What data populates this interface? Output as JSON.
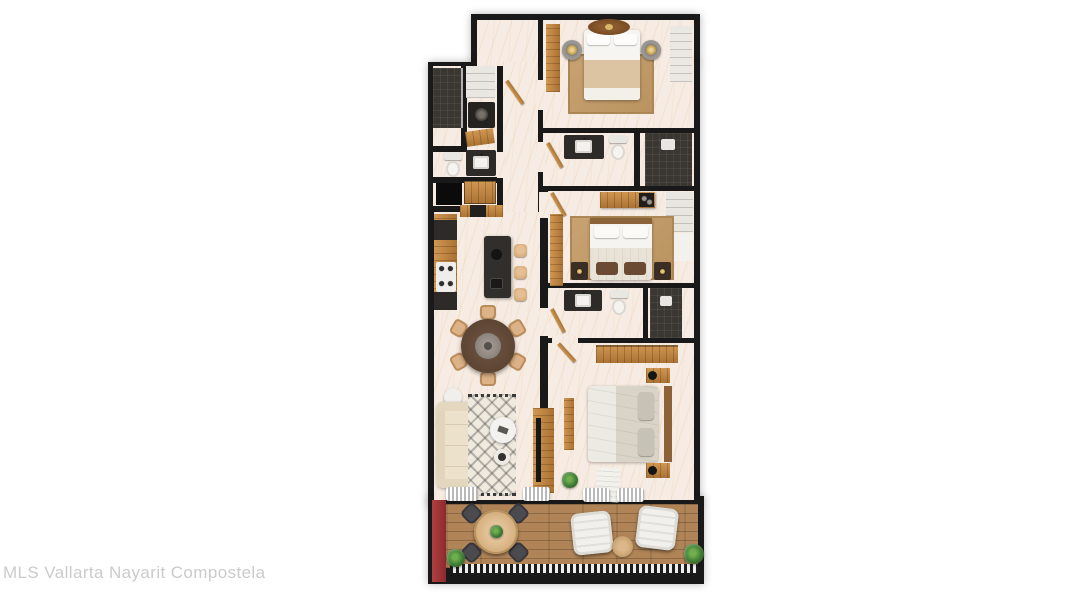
{
  "watermark": {
    "text": "MLS Vallarta Nayarit Compostela"
  },
  "palette": {
    "wall": "#191919",
    "floor": "#f6ece3",
    "tile": "#3a3733",
    "counter": "#2d2a27",
    "deck": "#b08457",
    "accent_red": "#9d3134",
    "rug_tan": "#c49e6c",
    "wood": "#c08445",
    "linen": "#f7f5f1",
    "blanket_tan": "#dcc3a1",
    "sofa_cream": "#ece2cc",
    "dining_table": "#5b4431",
    "plant": "#3f7a34",
    "lounge_gray": "#4b4a4f",
    "watermark": "#cbcbcb"
  }
}
